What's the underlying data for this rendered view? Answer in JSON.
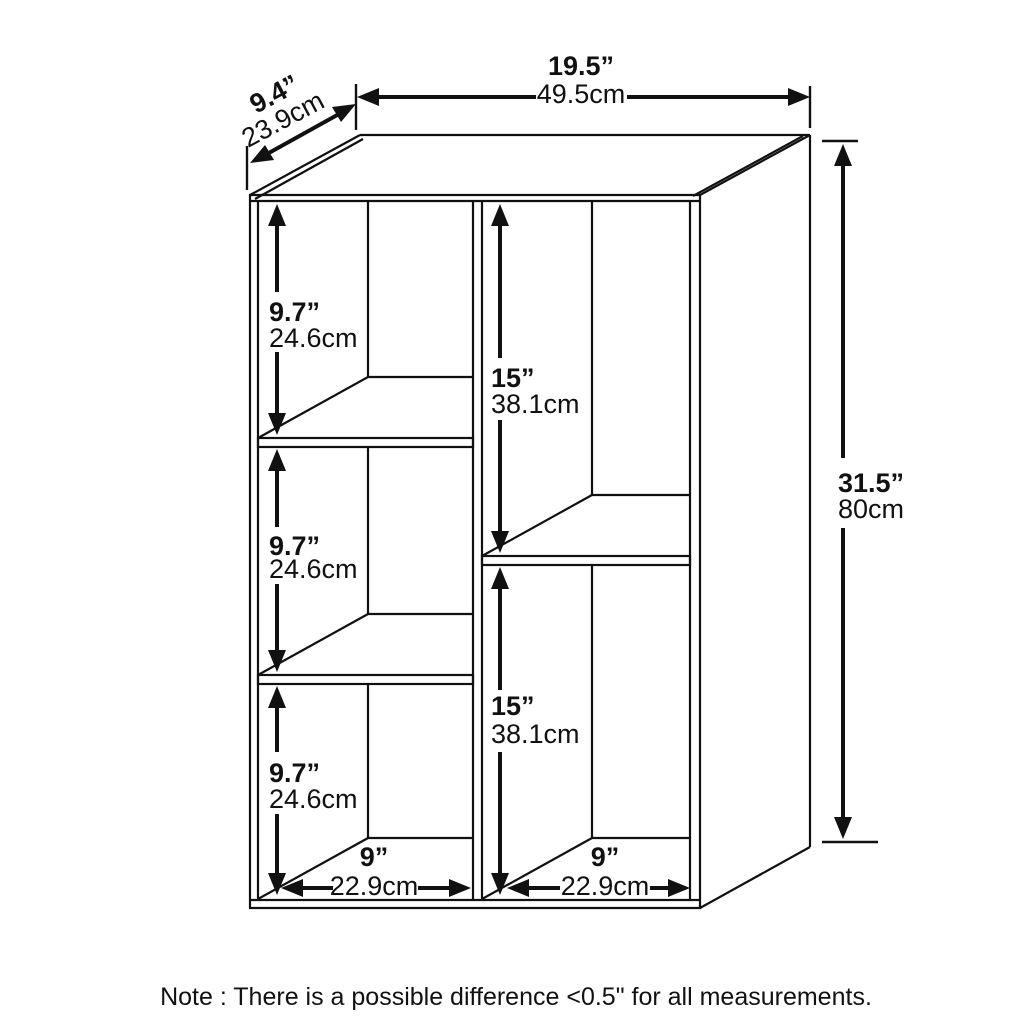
{
  "figure": {
    "subject": "5-compartment bookcase dimension diagram",
    "note": "Note : There is a possible difference <0.5\" for all measurements.",
    "colors": {
      "line": "#111111",
      "background": "#ffffff"
    }
  },
  "dimensions": {
    "overall_width": {
      "inches": "19.5”",
      "cm": "49.5cm"
    },
    "overall_depth": {
      "inches": "9.4”",
      "cm": "23.9cm"
    },
    "overall_height": {
      "inches": "31.5”",
      "cm": "80cm"
    },
    "left_compartment_1": {
      "inches": "9.7”",
      "cm": "24.6cm"
    },
    "left_compartment_2": {
      "inches": "9.7”",
      "cm": "24.6cm"
    },
    "left_compartment_3": {
      "inches": "9.7”",
      "cm": "24.6cm"
    },
    "right_compartment_1": {
      "inches": "15”",
      "cm": "38.1cm"
    },
    "right_compartment_2": {
      "inches": "15”",
      "cm": "38.1cm"
    },
    "left_compartment_width": {
      "inches": "9”",
      "cm": "22.9cm"
    },
    "right_compartment_width": {
      "inches": "9”",
      "cm": "22.9cm"
    }
  }
}
